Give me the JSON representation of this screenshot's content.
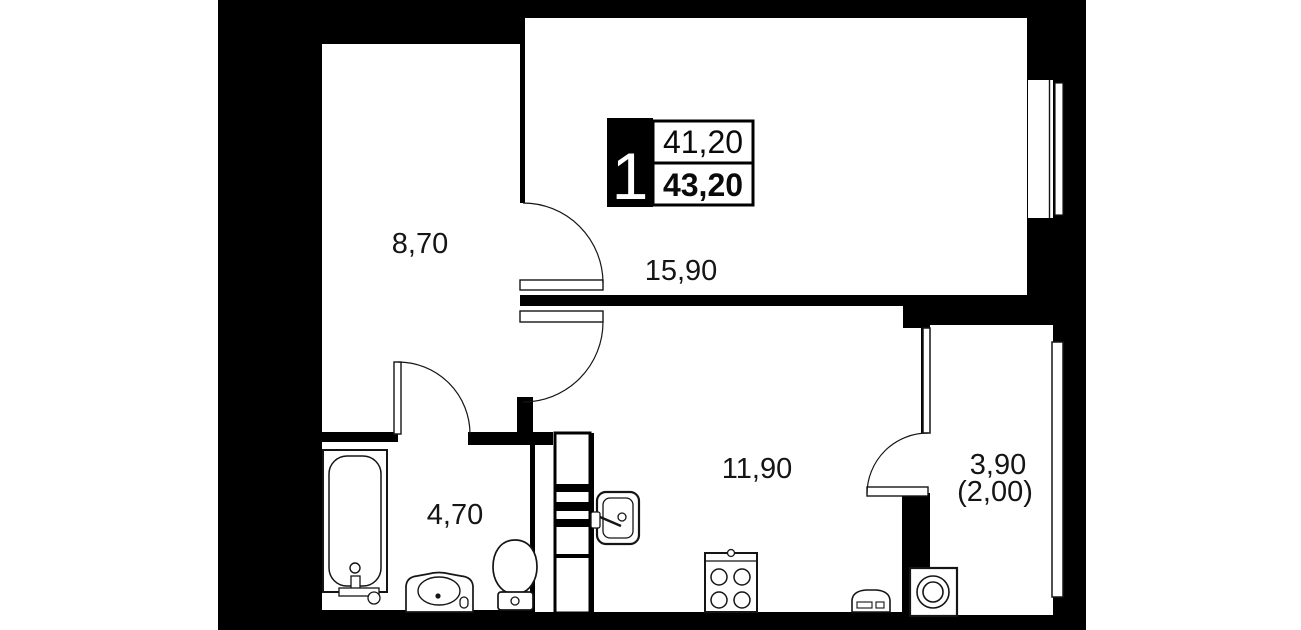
{
  "plan": {
    "unit_info": {
      "rooms_count": "1",
      "living_area": "41,20",
      "total_area": "43,20"
    },
    "labels": {
      "hall": "8,70",
      "living": "15,90",
      "kitchen": "11,90",
      "bathroom": "4,70",
      "balcony": "3,90",
      "balcony_reduced": "(2,00)"
    },
    "colors": {
      "wall": "#000000",
      "floor": "#ffffff",
      "line": "#151515"
    },
    "fixtures": [
      "bathtub",
      "bathroom-sink",
      "toilet",
      "kitchen-sink",
      "stove",
      "radiator",
      "washing-machine"
    ]
  }
}
